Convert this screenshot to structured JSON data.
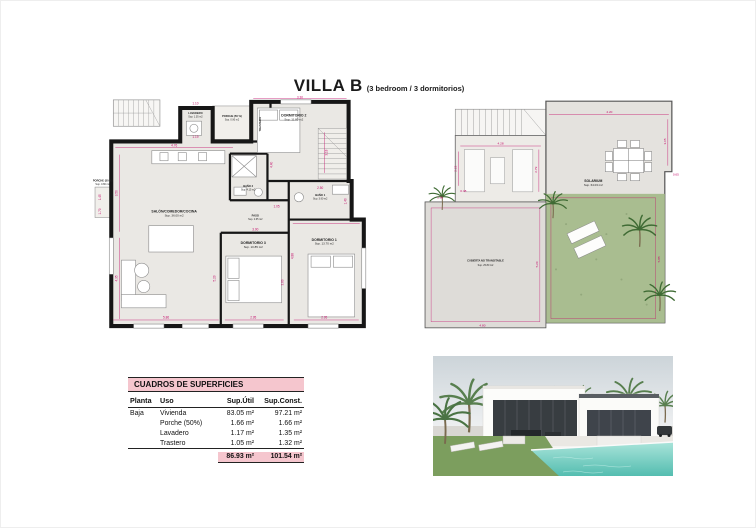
{
  "title": {
    "main": "VILLA B",
    "subtitle": "(3 bedroom / 3 dormitorios)"
  },
  "floor_plan": {
    "rooms": [
      {
        "label": "PORCHE (50 %)",
        "sup": "Sup. 0.90 m2"
      },
      {
        "label": "LAVADERO",
        "sup": "Sup. 1.35 m2"
      },
      {
        "label": "TRASTERO",
        "sup": ""
      },
      {
        "label": "DORMITORIO 2",
        "sup": "Sup. 11.80 m2"
      },
      {
        "label": "SALÓN/COMEDOR/COCINA",
        "sup": "Sup. 36.00 m2"
      },
      {
        "label": "BAÑO 2",
        "sup": "Sup. 4.15 m2"
      },
      {
        "label": "BAÑO 1",
        "sup": "Sup. 3.90 m2"
      },
      {
        "label": "PASO",
        "sup": "Sup. 2.65 m2"
      },
      {
        "label": "DORMITORIO 3",
        "sup": "Sup. 10.85 m2"
      },
      {
        "label": "DORMITORIO 1",
        "sup": "Sup. 13.70 m2"
      },
      {
        "label": "PORCHE (50 %)",
        "sup": "Sup. 0.80 m2"
      }
    ],
    "dims": [
      "4.76",
      "3.50",
      "4.35",
      "5.86",
      "3.30",
      "3.18",
      "4.40",
      "2.50",
      "1.40",
      "1.05",
      "3.00",
      "5.20",
      "3.80",
      "4.88",
      "2.95",
      "2.95",
      "1.10",
      "1.19",
      "1.45",
      "1.70"
    ]
  },
  "roof_plan": {
    "rooms": [
      {
        "label": "SOLARIUM",
        "sup": "Sup. 64.03 m2"
      },
      {
        "label": "CUBIERTA NO TRANSITABLE",
        "sup": "Sup. 25.80 m2"
      }
    ],
    "dims": [
      "4.20",
      "3.05",
      "4.28",
      "2.22",
      "2.79",
      "0.48",
      "0.65",
      "5.20",
      "4.80",
      "5.85",
      "1.90"
    ]
  },
  "table": {
    "title": "CUADROS DE SUPERFICIES",
    "columns": [
      "Planta",
      "Uso",
      "Sup.Útil",
      "Sup.Const."
    ],
    "rows": [
      {
        "planta": "Baja",
        "uso": "Vivienda",
        "util": "83.05 m²",
        "const": "97.21 m²"
      },
      {
        "planta": "",
        "uso": "Porche (50%)",
        "util": "1.66 m²",
        "const": "1.66 m²"
      },
      {
        "planta": "",
        "uso": "Lavadero",
        "util": "1.17 m²",
        "const": "1.35 m²"
      },
      {
        "planta": "",
        "uso": "Trastero",
        "util": "1.05 m²",
        "const": "1.32 m²"
      }
    ],
    "total": {
      "util": "86.93 m²",
      "const": "101.54 m²"
    }
  },
  "colors": {
    "dimension_pink": "#c40d6a",
    "table_pink": "#f5c6ce",
    "grass_green": "#a9bd90",
    "palm_green": "#3f6b34",
    "pool_aqua": "#6fccbf",
    "wall_black": "#161616",
    "floor_fill": "#eae8e4"
  }
}
